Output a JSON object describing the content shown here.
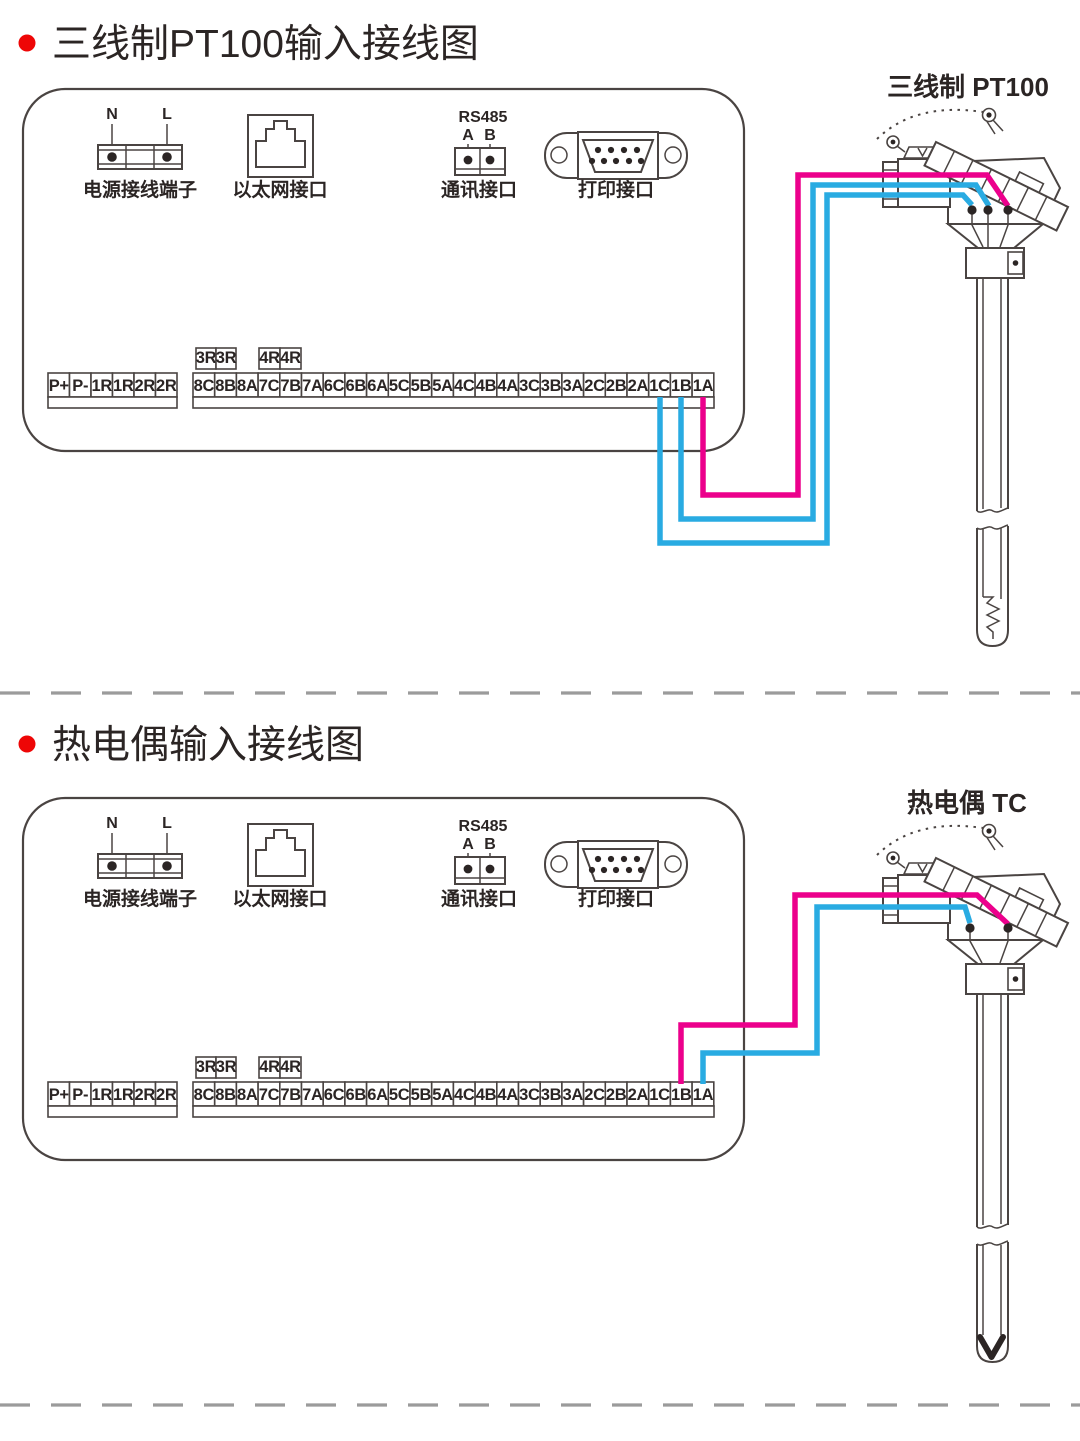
{
  "colors": {
    "magenta": "#ec008c",
    "cyan": "#29abe2",
    "ink": "#2b2524",
    "line": "#4a4442",
    "bullet": "#ee0606",
    "dash": "#9b9b9b",
    "background": "#ffffff"
  },
  "sections": [
    {
      "title": "三线制PT100输入接线图",
      "sensor_label": "三线制 PT100",
      "connections": [
        {
          "terminal": "1A",
          "color": "magenta"
        },
        {
          "terminal": "1B",
          "color": "cyan"
        },
        {
          "terminal": "1C",
          "color": "cyan"
        }
      ]
    },
    {
      "title": "热电偶输入接线图",
      "sensor_label": "热电偶 TC",
      "connections": [
        {
          "terminal": "1B",
          "color": "magenta"
        },
        {
          "terminal": "1A",
          "color": "cyan"
        }
      ]
    }
  ],
  "panel": {
    "power": {
      "n": "N",
      "l": "L",
      "label": "电源接线端子"
    },
    "ethernet": {
      "label": "以太网接口"
    },
    "rs485": {
      "title": "RS485",
      "a": "A",
      "b": "B",
      "label": "通讯接口"
    },
    "printer": {
      "label": "打印接口"
    },
    "left_terminals": [
      "P+",
      "P-",
      "1R",
      "1R",
      "2R",
      "2R"
    ],
    "relay_3r": [
      "3R",
      "3R"
    ],
    "relay_4r": [
      "4R",
      "4R"
    ],
    "main_terminals": [
      "8C",
      "8B",
      "8A",
      "7C",
      "7B",
      "7A",
      "6C",
      "6B",
      "6A",
      "5C",
      "5B",
      "5A",
      "4C",
      "4B",
      "4A",
      "3C",
      "3B",
      "3A",
      "2C",
      "2B",
      "2A",
      "1C",
      "1B",
      "1A"
    ]
  }
}
